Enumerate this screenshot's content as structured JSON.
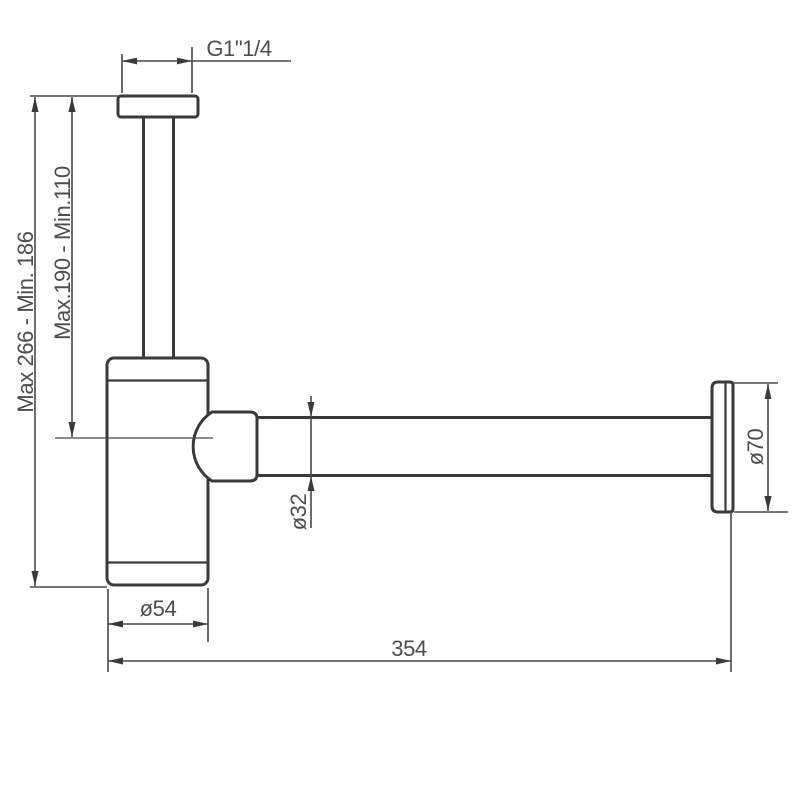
{
  "drawing": {
    "title": "Bottle trap dimension drawing",
    "labels": {
      "thread": "G1\"1/4",
      "overall_height": "Max 266 - Min. 186",
      "inlet_height": "Max.190 - Min.110",
      "pipe_diameter": "ø32",
      "flange_diameter": "ø70",
      "body_diameter": "ø54",
      "horizontal_length": "354"
    },
    "colors": {
      "outline": "#3a3a3e",
      "dimension_line": "#48484c",
      "text": "#4d4d4d",
      "background": "#ffffff"
    }
  }
}
